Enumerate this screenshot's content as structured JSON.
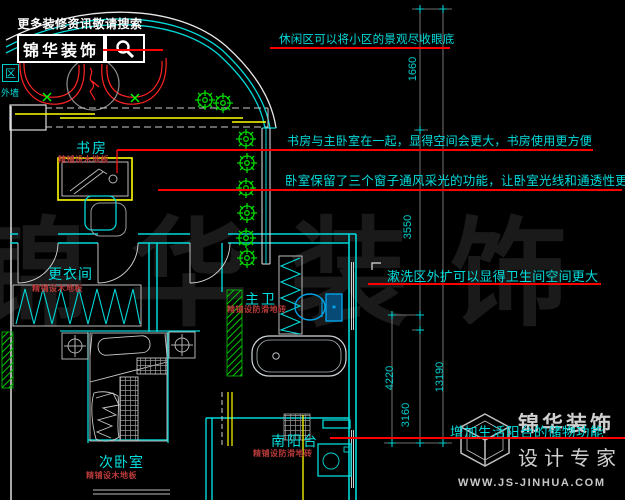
{
  "logo": {
    "tagline": "更多装修资讯敬请搜索",
    "brand": "锦华装饰"
  },
  "area_label": {
    "name": "区",
    "wall": "外墙"
  },
  "annotations": [
    "休闲区可以将小区的景观尽收眼底",
    "书房与主卧室在一起，显得空间会更大，书房使用更方便",
    "卧室保留了三个窗子通风采光的功能，让卧室光线和通透性更好",
    "漱洗区外扩可以显得卫生间空间更大",
    "增加生活阳台的储物功能"
  ],
  "rooms": [
    {
      "name": "书房",
      "finish": "精铺设木地板"
    },
    {
      "name": "更衣间",
      "finish": "精铺设木地板"
    },
    {
      "name": "主卫",
      "finish": "精铺设防滑地砖"
    },
    {
      "name": "次卧室",
      "finish": "精铺设木地板"
    },
    {
      "name": "南阳台",
      "finish": "精铺设防滑地砖"
    }
  ],
  "dimensions": [
    "1660",
    "3550",
    "4220",
    "3160",
    "13190"
  ],
  "watermark_center": "锦华装饰",
  "watermark_footer": {
    "brand": "锦华装饰",
    "slogan": "设计专家",
    "website": "WWW.JS-JINHUA.COM"
  },
  "colors": {
    "background": "#000000",
    "wall_cyan": "#00d9d9",
    "annotation_cyan": "#00dcdc",
    "leader_red": "#ff0000",
    "furniture_yellow": "#ffff00",
    "plant_green": "#00d800",
    "finish_red": "#b83a3a",
    "toilet_blue": "#00a2e8"
  }
}
